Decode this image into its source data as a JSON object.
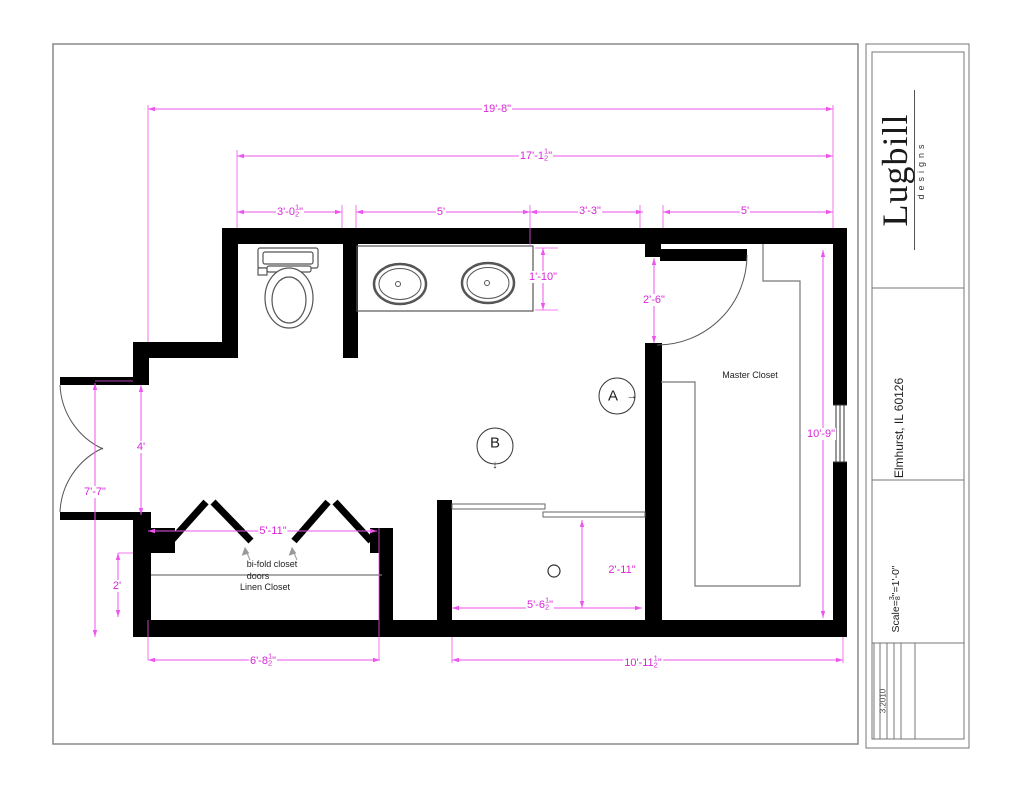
{
  "dimensions": {
    "overall_width": {
      "pre": "19'-8\""
    },
    "upper_width": {
      "pre": "17'-1",
      "num": "1",
      "den": "2",
      "post": "\""
    },
    "toilet_width": {
      "pre": "3'-0",
      "num": "1",
      "den": "2",
      "post": "\""
    },
    "vanity_width": {
      "pre": "5'"
    },
    "mid_segment": {
      "pre": "3'-3\""
    },
    "closet_width": {
      "pre": "5'"
    },
    "vanity_depth": {
      "pre": "1'-10\""
    },
    "closet_door": {
      "pre": "2'-6\""
    },
    "closet_height": {
      "pre": "10'-9\""
    },
    "entry_opening": {
      "pre": "4'"
    },
    "left_height": {
      "pre": "7'-7\""
    },
    "left_lower": {
      "pre": "2'"
    },
    "bifold_width": {
      "pre": "5'-11\""
    },
    "linen_width": {
      "pre": "6'-8",
      "num": "1",
      "den": "2",
      "post": "\""
    },
    "shower_width": {
      "pre": "5'-6",
      "num": "1",
      "den": "2",
      "post": "\""
    },
    "shower_depth": {
      "pre": "2'-11\""
    },
    "bottom_width": {
      "pre": "10'-11",
      "num": "1",
      "den": "2",
      "post": "\""
    }
  },
  "labels": {
    "master_closet": "Master Closet",
    "bifold_line1": "bi-fold closet",
    "bifold_line2": "doors",
    "linen_closet": "Linen Closet"
  },
  "markers": {
    "a": "A",
    "a_arrow": "→",
    "b": "B",
    "b_arrow": "↓"
  },
  "title_block": {
    "brand": "Lugbill",
    "brand_sub": "designs",
    "address": "Elmhurst, IL 60126",
    "scale_pre": "Scale= ",
    "scale_num": "3",
    "scale_den": "8",
    "scale_post": "\"=1'-0\"",
    "revision": "3.2010"
  },
  "colors": {
    "dimension_text": "#d926d9",
    "dimension_line": "#ee55ee",
    "wall": "#000000"
  }
}
